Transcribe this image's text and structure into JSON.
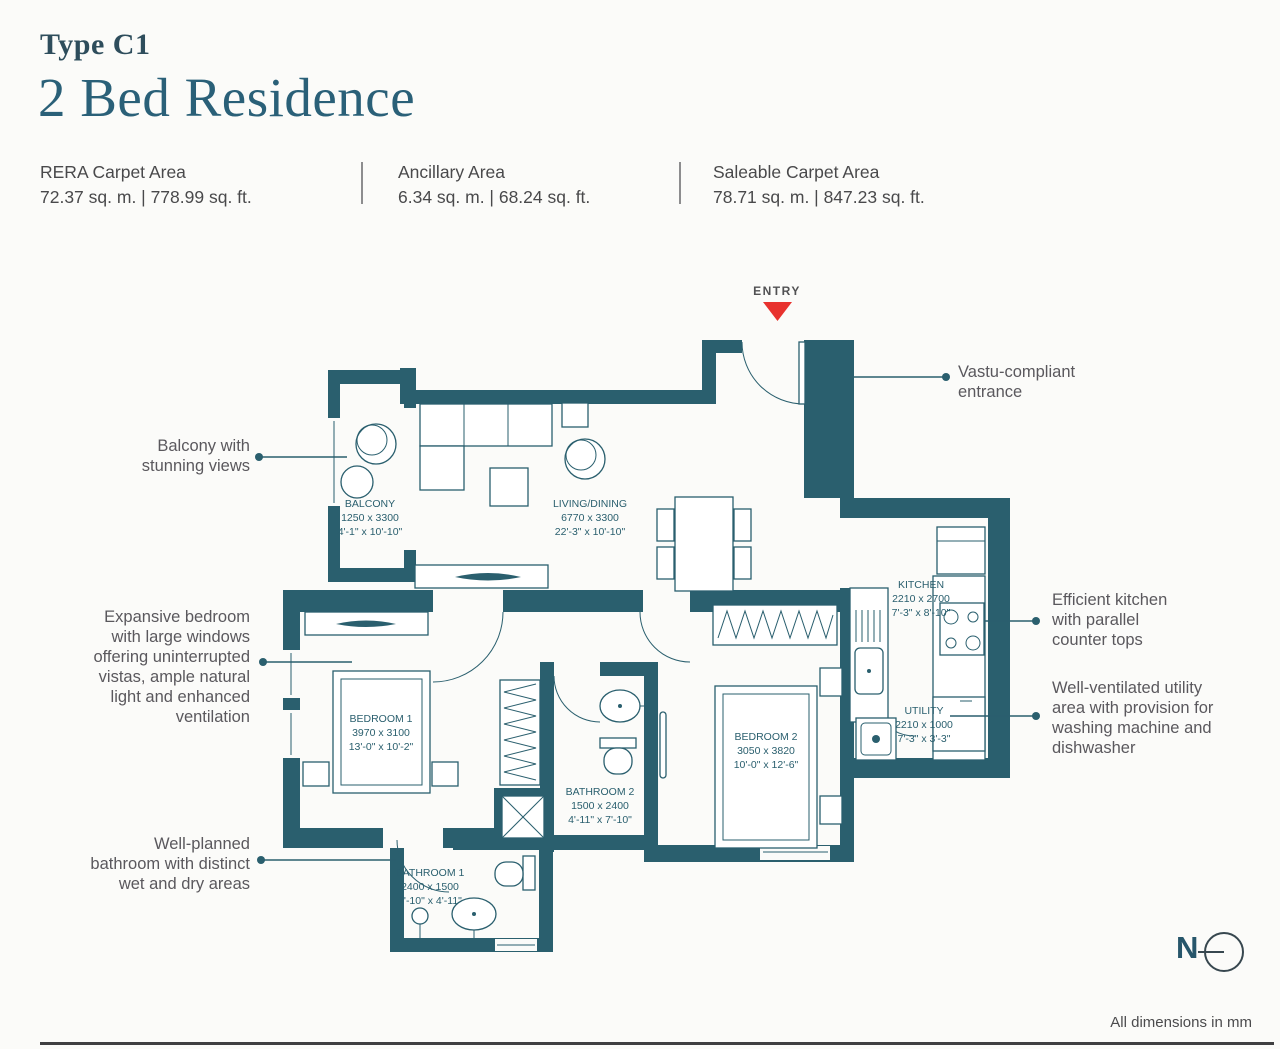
{
  "header": {
    "type_label": "Type C1",
    "title": "2 Bed Residence"
  },
  "stats": [
    {
      "label": "RERA Carpet Area",
      "value": "72.37 sq. m. | 778.99 sq. ft."
    },
    {
      "label": "Ancillary Area",
      "value": "6.34 sq. m. | 68.24 sq. ft."
    },
    {
      "label": "Saleable Carpet Area",
      "value": "78.71 sq. m. | 847.23 sq. ft."
    }
  ],
  "plan": {
    "entry_label": "ENTRY",
    "rooms": [
      {
        "name": "BALCONY",
        "dim_mm": "1250 x 3300",
        "dim_ft": "4'-1\" x 10'-10\""
      },
      {
        "name": "LIVING/DINING",
        "dim_mm": "6770 x 3300",
        "dim_ft": "22'-3\" x 10'-10\""
      },
      {
        "name": "KITCHEN",
        "dim_mm": "2210 x 2700",
        "dim_ft": "7'-3\" x 8'-10\""
      },
      {
        "name": "BEDROOM 1",
        "dim_mm": "3970 x 3100",
        "dim_ft": "13'-0\" x 10'-2\""
      },
      {
        "name": "BEDROOM 2",
        "dim_mm": "3050 x 3820",
        "dim_ft": "10'-0\" x 12'-6\""
      },
      {
        "name": "BATHROOM 2",
        "dim_mm": "1500 x 2400",
        "dim_ft": "4'-11\" x 7'-10\""
      },
      {
        "name": "UTILITY",
        "dim_mm": "2210 x 1000",
        "dim_ft": "7'-3\" x 3'-3\""
      },
      {
        "name": "BATHROOM 1",
        "dim_mm": "2400 x 1500",
        "dim_ft": "7'-10\" x 4'-11\""
      }
    ],
    "annotations": [
      {
        "id": "balcony",
        "text": "Balcony with\nstunning views"
      },
      {
        "id": "bedroom",
        "text": "Expansive bedroom\nwith large windows\noffering uninterrupted\nvistas, ample natural\nlight and enhanced\nventilation"
      },
      {
        "id": "bathroom",
        "text": "Well-planned\nbathroom with distinct\nwet and dry areas"
      },
      {
        "id": "entrance",
        "text": "Vastu-compliant\nentrance"
      },
      {
        "id": "kitchen",
        "text": "Efficient kitchen\nwith parallel\ncounter tops"
      },
      {
        "id": "utility",
        "text": "Well-ventilated utility\narea with provision for\nwashing machine and\ndishwasher"
      }
    ]
  },
  "compass": {
    "north_label": "N"
  },
  "footnote": "All dimensions in mm",
  "colors": {
    "wall": "#2a5f6e",
    "entry_arrow": "#e8322e",
    "title": "#2a6078"
  }
}
